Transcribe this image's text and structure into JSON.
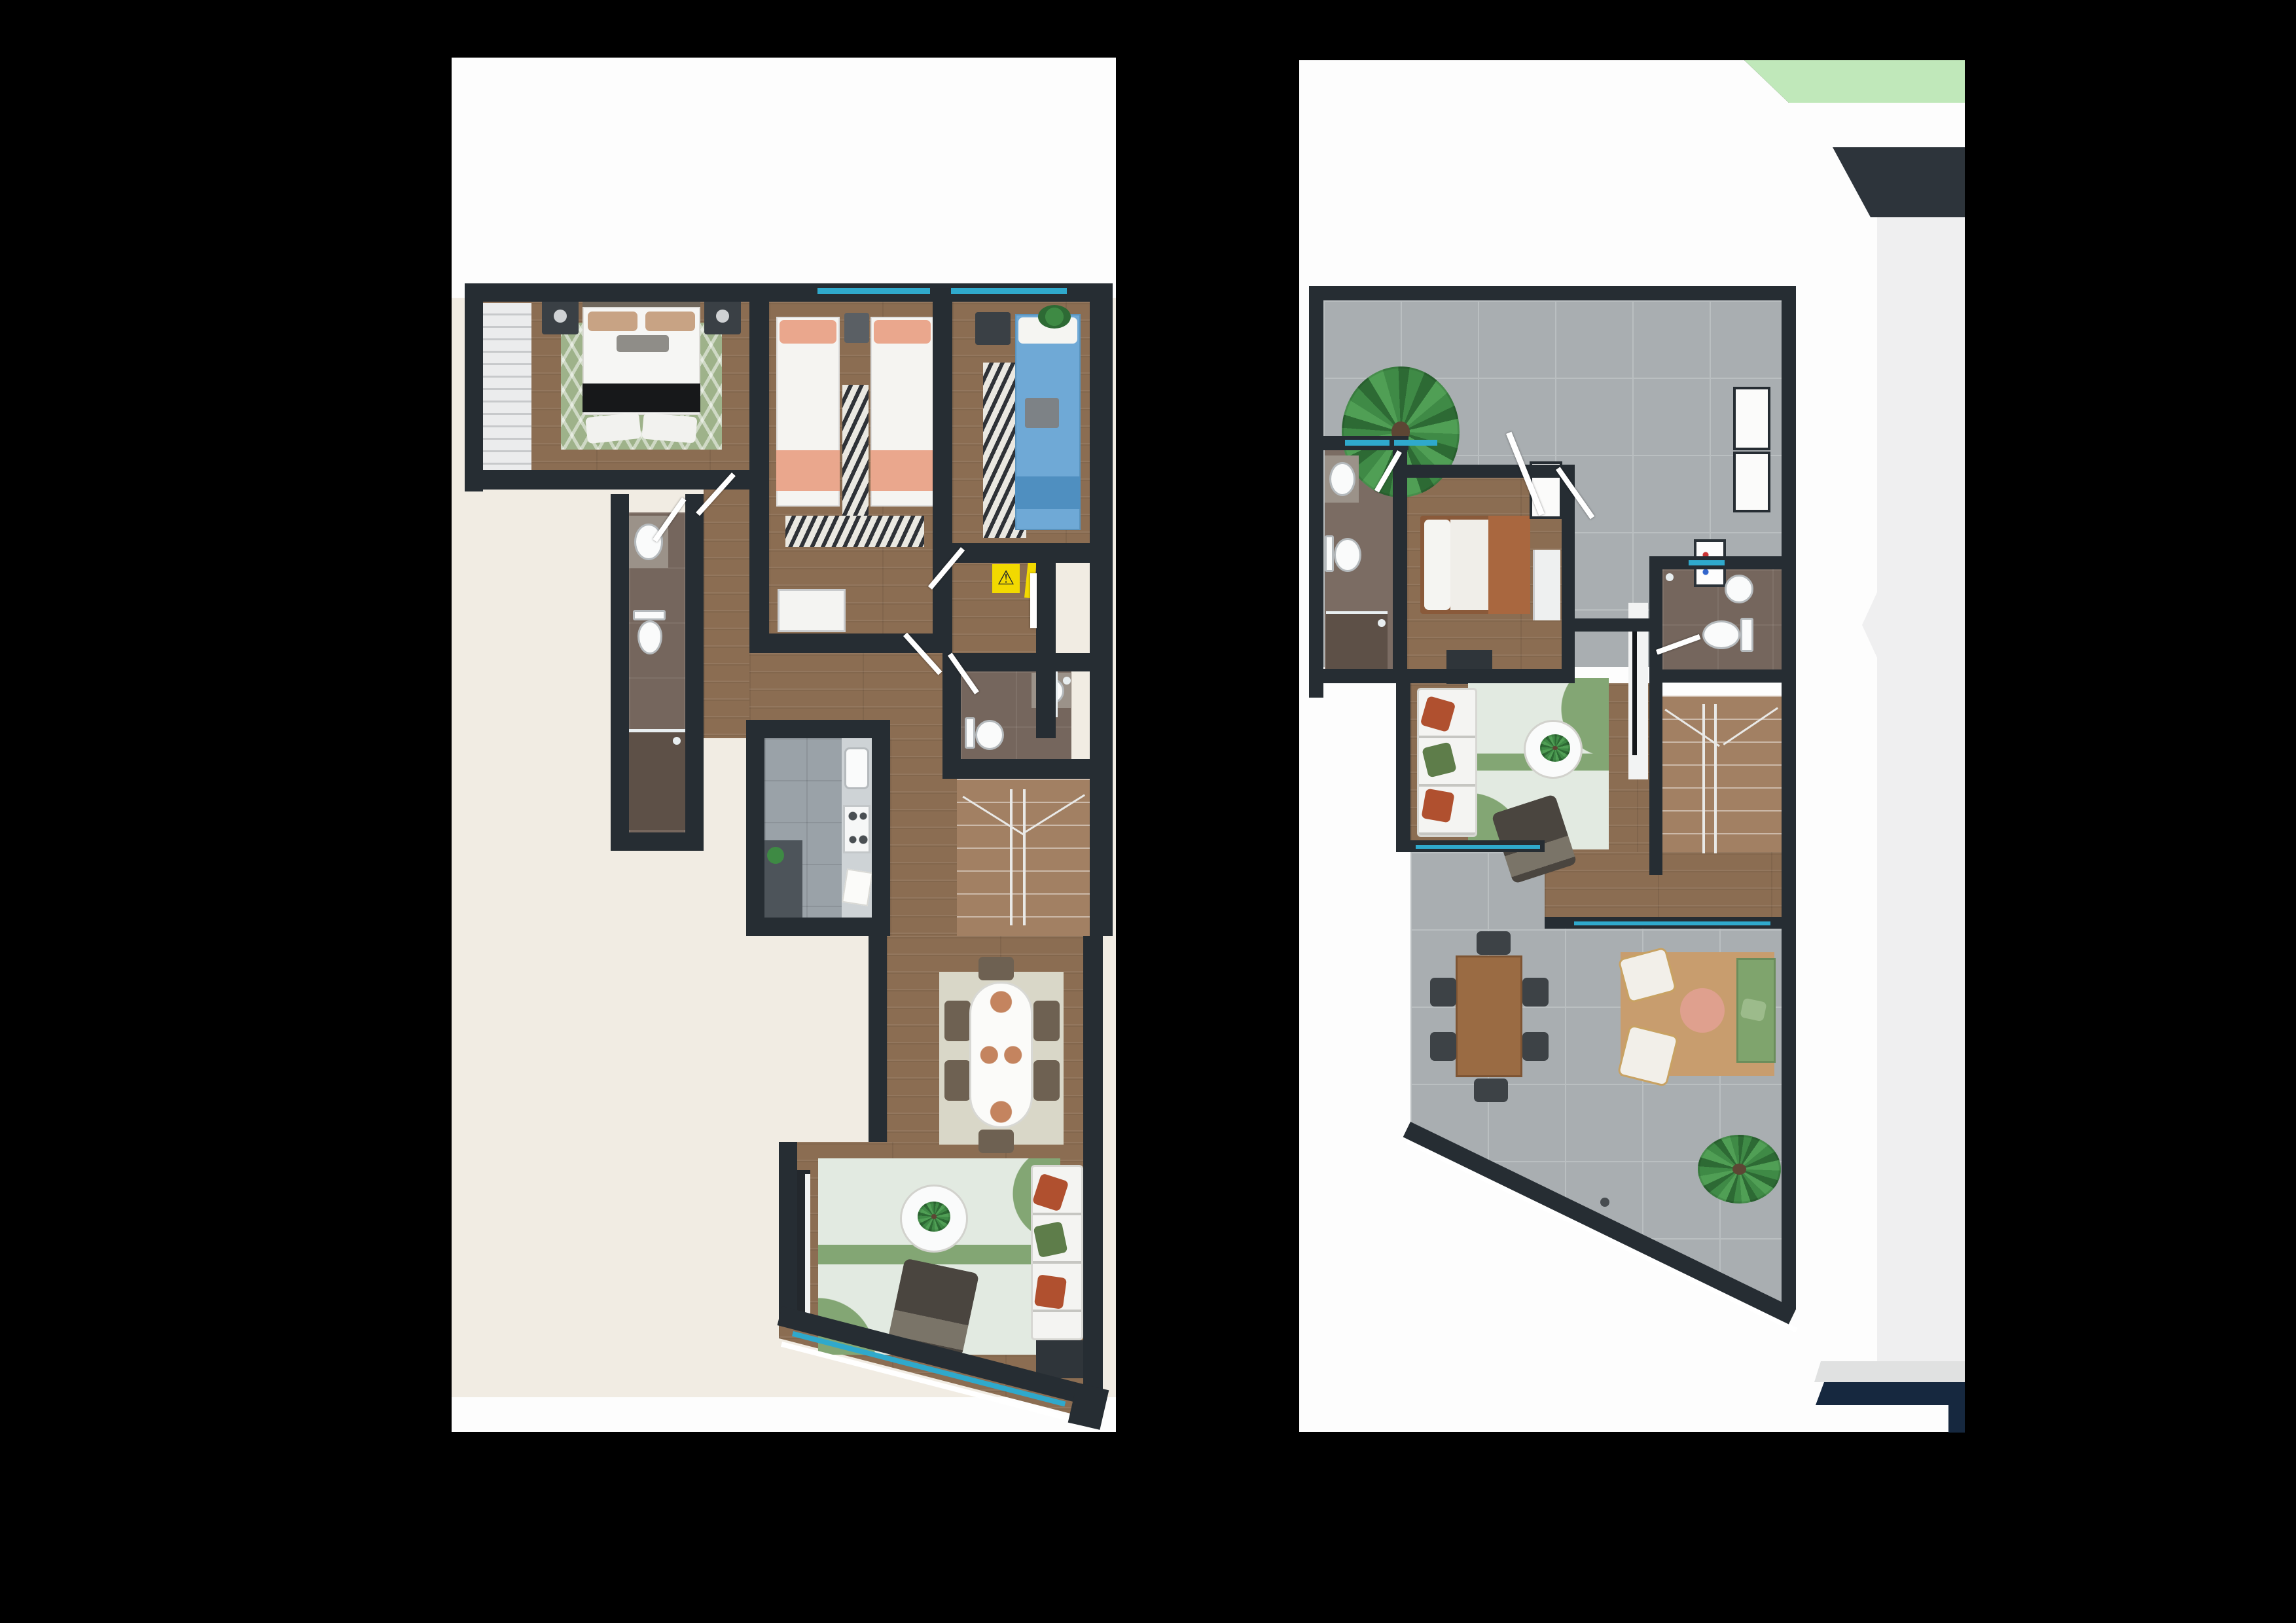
{
  "theme": {
    "css_vars": "--bg:#000000;--paper:#fdfdfd;--cream:#f1ece3;--wall:#262d33;--wood:#8b6d52;--stair:#a28063;--terrace:#a9aeb1;--tline:#babfc1;--bath:#75665d;--bath2:#5d5047;--kfloor:#9aa2a8;--counter:#ced3d6;--cab:#4d545a;--closet:#ebeced;--cyan:#2fa9cc;--yellow:#f2d900;--navy:#16283f;--greenstrip:#c0e8ba;--trap:#2d343b;--lgray:#efeff0;--lgray2:#e0e1e1;--ruggreen:#9eb28a;--livrug:#e2eae1;--livgreen:#83a674;--zebra:#2f3237;--zebralight:#eae8e1;--peach:#eaa78d;--bluebed:#6fa9d6;--tan:#c89d6e;--sofagreen:#7fa46d;--pink:#dfa08e;--chair:#3d4246;--wood-table:#9a6b43;--dark-furn:#3a4045;--arm:#4a453f"
  },
  "icons": {
    "warning_glyph": "⚠"
  },
  "plans": [
    {
      "id": "level-1",
      "rooms": [
        "master-bedroom",
        "bedroom-2",
        "bedroom-3",
        "master-bathroom",
        "hall-bathroom",
        "hallway",
        "entry",
        "kitchen",
        "staircase",
        "dining-area",
        "living-room"
      ],
      "furniture": [
        "double-bed",
        "wardrobe-closet",
        "nightstand",
        "nightstand",
        "single-bed",
        "single-bed",
        "zebra-runner",
        "wardrobe-niche",
        "single-bed-blue",
        "zebra-rug",
        "plant",
        "sink",
        "toilet",
        "shower",
        "sink",
        "toilet",
        "shower",
        "kitchen-counter",
        "kitchen-sink",
        "stove",
        "base-cabinets",
        "dining-table",
        "dining-chair",
        "dining-chair",
        "dining-chair",
        "dining-chair",
        "dining-chair",
        "dining-chair",
        "area-rug",
        "sofa",
        "coffee-table",
        "armchair",
        "tv-console",
        "warning-sign",
        "window",
        "window",
        "window"
      ]
    },
    {
      "id": "level-2",
      "rooms": [
        "upper-terrace",
        "terrace-bathroom",
        "guest-bedroom",
        "upper-bathroom",
        "family-room",
        "staircase",
        "lower-terrace"
      ],
      "furniture": [
        "potted-plant",
        "sink",
        "toilet",
        "shower",
        "single-bed",
        "closet",
        "storage-box",
        "storage-box",
        "electrical-panel",
        "sink",
        "toilet",
        "sofa",
        "area-rug",
        "coffee-table",
        "armchair",
        "tv-panel",
        "outdoor-dining-table",
        "outdoor-chair",
        "outdoor-chair",
        "outdoor-chair",
        "outdoor-chair",
        "outdoor-chair",
        "outdoor-chair",
        "outdoor-rug",
        "lounge-chair",
        "lounge-chair",
        "round-side-table",
        "outdoor-sofa",
        "potted-plant",
        "window",
        "window",
        "window"
      ]
    }
  ],
  "side_graphics": [
    "green-strip-fragment",
    "charcoal-plan-fragment",
    "light-gray-sheet-fragment",
    "navy-band-fragment"
  ]
}
